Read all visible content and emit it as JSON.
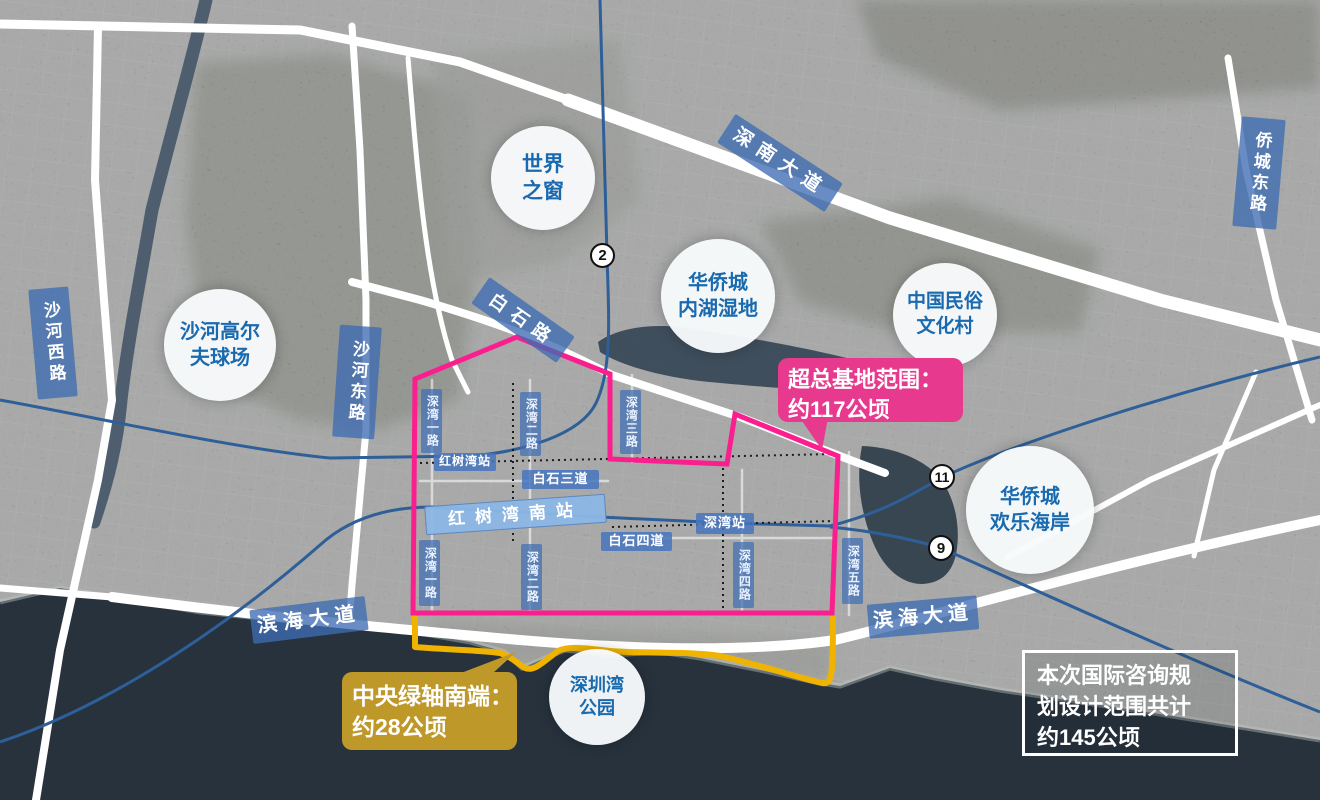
{
  "map": {
    "pois": [
      {
        "id": "window-of-the-world",
        "line1": "世界",
        "line2": "之窗"
      },
      {
        "id": "oct-inner-lake-wetland",
        "line1": "华侨城",
        "line2": "内湖湿地"
      },
      {
        "id": "china-folk-culture-village",
        "line1": "中国民俗",
        "line2": "文化村"
      },
      {
        "id": "shahe-golf-course",
        "line1": "沙河高尔",
        "line2": "夫球场"
      },
      {
        "id": "oct-happy-coast",
        "line1": "华侨城",
        "line2": "欢乐海岸"
      },
      {
        "id": "shenzhen-bay-park",
        "line1": "深圳湾",
        "line2": "公园"
      }
    ],
    "road_labels": [
      {
        "id": "shennan-avenue",
        "text": "深南大道"
      },
      {
        "id": "baishi-road",
        "text": "白石路"
      },
      {
        "id": "shahe-west-road",
        "text": "沙河西路"
      },
      {
        "id": "shahe-east-road",
        "text": "沙河东路"
      },
      {
        "id": "qiaocheng-east-road",
        "text": "侨城东路"
      },
      {
        "id": "binhai-avenue-west",
        "text": "滨海大道"
      },
      {
        "id": "binhai-avenue-east",
        "text": "滨海大道"
      },
      {
        "id": "shenwan-1st-road-north",
        "text": "深湾一路"
      },
      {
        "id": "shenwan-2nd-road-north",
        "text": "深湾二路"
      },
      {
        "id": "shenwan-3rd-road",
        "text": "深湾三路"
      },
      {
        "id": "shenwan-1st-road-south",
        "text": "深湾一路"
      },
      {
        "id": "shenwan-2nd-road-south",
        "text": "深湾二路"
      },
      {
        "id": "shenwan-4th-road",
        "text": "深湾四路"
      },
      {
        "id": "shenwan-5th-road",
        "text": "深湾五路"
      }
    ],
    "stations": [
      {
        "id": "hongshuwan-station",
        "text": "红树湾站"
      },
      {
        "id": "baishi-3rd-avenue",
        "text": "白石三道"
      },
      {
        "id": "hongshuwan-south-station",
        "text": "红树湾南站"
      },
      {
        "id": "baishi-4th-avenue",
        "text": "白石四道"
      },
      {
        "id": "shenwan-station",
        "text": "深湾站"
      }
    ],
    "metro_badges": [
      {
        "line": "2"
      },
      {
        "line": "11"
      },
      {
        "line": "9"
      }
    ],
    "callouts": {
      "super_hq": {
        "line1": "超总基地范围：",
        "line2": "约117公顷"
      },
      "green_axis": {
        "line1": "中央绿轴南端：",
        "line2": "约28公顷"
      },
      "total_scope": {
        "line1": "本次国际咨询规",
        "line2": "划设计范围共计",
        "line3": "约145公顷"
      }
    },
    "colors": {
      "boundary_pink": "#fb1e8e",
      "boundary_yellow": "#f0b400",
      "callout_pink_bg": "#e73a8e",
      "callout_gold_bg": "#bf982a",
      "road_label_bg": "#3e6cb2",
      "station_light_bg": "#8cb7e6",
      "poi_text": "#1a6ab0",
      "metro_line_blue": "#2e5f98",
      "sea": "#27323d"
    }
  }
}
